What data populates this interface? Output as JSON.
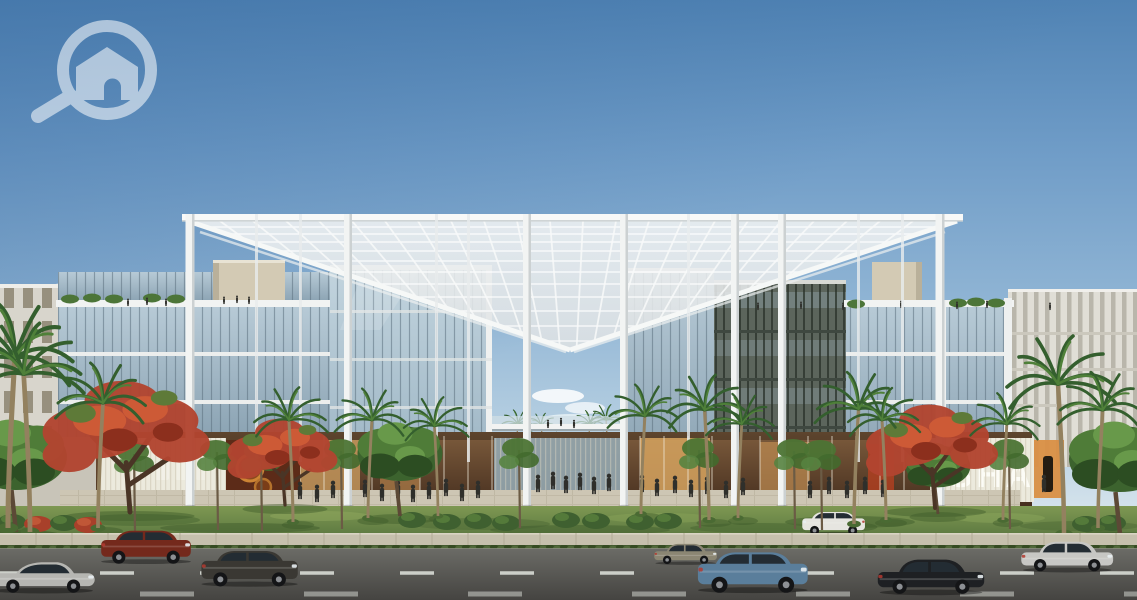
{
  "meta": {
    "type": "architectural-rendering",
    "subject": "Modern mixed-use office complex with large white pergola canopy, glass facades, palm and flame trees, plaza with pedestrians, and a street with cars",
    "canvas": {
      "w": 1137,
      "h": 600
    }
  },
  "watermark": {
    "icon": "magnifier-home-logo",
    "color": "#ffffff",
    "opacity": 0.55
  },
  "signage": {
    "storefront_sign": "SHA"
  },
  "palette": {
    "sky_top": "#5083b4",
    "sky_horizon": "#e8f0f3",
    "canopy": "#eef1f1",
    "glass": "#9fb6c5",
    "glass_dark": "#5c655c",
    "stone": "#d3cab4",
    "lawn": "#6d8a47",
    "road": "#55544f",
    "storefront_glow": "#c89a5e",
    "flame_tree": "#b24530",
    "palm_green": "#345f2e",
    "car_colors": [
      "#b6b6b2",
      "#74291c",
      "#3a3833",
      "#8b8673",
      "#5a7e9b",
      "#e6e5e0",
      "#1e2023",
      "#c7c7c4"
    ]
  },
  "scene": {
    "cars": [
      {
        "name": "car-silver-coupe",
        "type": "coupe",
        "color": "#b6b6b2",
        "x": -12,
        "y": 553,
        "s": 0.92
      },
      {
        "name": "car-dark-red-suv",
        "type": "suv",
        "color": "#74291c",
        "x": 98,
        "y": 528,
        "s": 0.8
      },
      {
        "name": "car-charcoal-suv",
        "type": "suv",
        "color": "#3a3833",
        "x": 198,
        "y": 548,
        "s": 0.86
      },
      {
        "name": "car-olive-sedan",
        "type": "sedan",
        "color": "#8b8673",
        "x": 652,
        "y": 540,
        "s": 0.56
      },
      {
        "name": "car-blue-suv",
        "type": "suv",
        "color": "#5a7e9b",
        "x": 694,
        "y": 549,
        "s": 0.98
      },
      {
        "name": "car-white-suv",
        "type": "suv",
        "color": "#e6e5e0",
        "x": 800,
        "y": 510,
        "s": 0.56,
        "flip": true,
        "behind": true
      },
      {
        "name": "car-black-sedan",
        "type": "sedan",
        "color": "#1e2023",
        "x": 874,
        "y": 553,
        "s": 0.95
      },
      {
        "name": "car-silver-sedan",
        "type": "sedan",
        "color": "#c7c7c4",
        "x": 1018,
        "y": 536,
        "s": 0.82
      }
    ],
    "palms": [
      {
        "x": 8,
        "y": 528,
        "h": 170
      },
      {
        "x": 30,
        "y": 532,
        "h": 158,
        "flip": 1
      },
      {
        "x": 98,
        "y": 528,
        "h": 125
      },
      {
        "x": 293,
        "y": 522,
        "h": 102,
        "flip": 1
      },
      {
        "x": 368,
        "y": 518,
        "h": 98
      },
      {
        "x": 438,
        "y": 516,
        "h": 90,
        "flip": 1
      },
      {
        "x": 641,
        "y": 514,
        "h": 98
      },
      {
        "x": 709,
        "y": 520,
        "h": 110,
        "flip": 1
      },
      {
        "x": 738,
        "y": 518,
        "h": 94
      },
      {
        "x": 854,
        "y": 524,
        "h": 115
      },
      {
        "x": 886,
        "y": 520,
        "h": 100,
        "flip": 1
      },
      {
        "x": 1003,
        "y": 520,
        "h": 96
      },
      {
        "x": 1064,
        "y": 534,
        "h": 150,
        "flip": 1
      },
      {
        "x": 1098,
        "y": 528,
        "h": 118
      }
    ],
    "gap_palms": [
      {
        "x": 516,
        "y": 468,
        "h": 44
      },
      {
        "x": 543,
        "y": 466,
        "h": 40,
        "flip": 1
      },
      {
        "x": 588,
        "y": 466,
        "h": 42
      },
      {
        "x": 608,
        "y": 468,
        "h": 48,
        "flip": 1
      }
    ],
    "flame_trees": [
      {
        "x": 130,
        "y": 512,
        "s": 1.9
      },
      {
        "x": 285,
        "y": 505,
        "s": 1.25
      },
      {
        "x": 935,
        "y": 508,
        "s": 1.5
      }
    ],
    "green_trees": [
      {
        "x": 400,
        "y": 516,
        "s": 1.25
      },
      {
        "x": 938,
        "y": 514,
        "s": 0.95
      },
      {
        "x": 16,
        "y": 532,
        "s": 1.5
      },
      {
        "x": 1120,
        "y": 534,
        "s": 1.5
      }
    ],
    "street_trees": [
      {
        "x": 135,
        "y": 532
      },
      {
        "x": 218,
        "y": 530
      },
      {
        "x": 262,
        "y": 531
      },
      {
        "x": 342,
        "y": 529
      },
      {
        "x": 520,
        "y": 528
      },
      {
        "x": 700,
        "y": 528
      },
      {
        "x": 795,
        "y": 529
      },
      {
        "x": 822,
        "y": 530
      },
      {
        "x": 1010,
        "y": 529
      }
    ],
    "bushes": [
      {
        "x": 12,
        "y": 522
      },
      {
        "x": 38,
        "y": 524,
        "red": true
      },
      {
        "x": 64,
        "y": 523
      },
      {
        "x": 88,
        "y": 525,
        "red": true
      },
      {
        "x": 412,
        "y": 520
      },
      {
        "x": 447,
        "y": 522
      },
      {
        "x": 478,
        "y": 521
      },
      {
        "x": 506,
        "y": 523
      },
      {
        "x": 566,
        "y": 520
      },
      {
        "x": 596,
        "y": 521
      },
      {
        "x": 640,
        "y": 522
      },
      {
        "x": 668,
        "y": 521
      },
      {
        "x": 1086,
        "y": 524
      },
      {
        "x": 1112,
        "y": 523
      }
    ],
    "roof_plants": [
      {
        "x": 70,
        "y": 299
      },
      {
        "x": 92,
        "y": 298
      },
      {
        "x": 114,
        "y": 299
      },
      {
        "x": 152,
        "y": 298
      },
      {
        "x": 176,
        "y": 299
      },
      {
        "x": 856,
        "y": 304
      },
      {
        "x": 958,
        "y": 303
      },
      {
        "x": 976,
        "y": 302
      },
      {
        "x": 996,
        "y": 303
      }
    ],
    "people_plaza": [
      [
        300,
        499
      ],
      [
        317,
        502
      ],
      [
        333,
        498
      ],
      [
        349,
        503
      ],
      [
        365,
        497
      ],
      [
        382,
        501
      ],
      [
        398,
        498
      ],
      [
        413,
        502
      ],
      [
        429,
        499
      ],
      [
        446,
        496
      ],
      [
        462,
        501
      ],
      [
        478,
        498
      ],
      [
        538,
        492
      ],
      [
        553,
        489
      ],
      [
        566,
        493
      ],
      [
        580,
        490
      ],
      [
        594,
        494
      ],
      [
        609,
        491
      ],
      [
        625,
        495
      ],
      [
        642,
        492
      ],
      [
        657,
        496
      ],
      [
        675,
        493
      ],
      [
        691,
        497
      ],
      [
        707,
        494
      ],
      [
        726,
        498
      ],
      [
        743,
        495
      ],
      [
        810,
        498
      ],
      [
        829,
        494
      ],
      [
        847,
        498
      ],
      [
        865,
        494
      ],
      [
        883,
        497
      ],
      [
        1044,
        492
      ]
    ],
    "people_roof": [
      [
        128,
        306
      ],
      [
        147,
        305
      ],
      [
        166,
        306
      ],
      [
        224,
        304
      ],
      [
        237,
        303
      ],
      [
        249,
        304
      ],
      [
        758,
        310
      ],
      [
        801,
        309
      ],
      [
        843,
        310
      ],
      [
        901,
        308
      ],
      [
        957,
        309
      ],
      [
        987,
        308
      ],
      [
        1050,
        310
      ]
    ],
    "people_bridge": [
      [
        548,
        428
      ],
      [
        561,
        426
      ],
      [
        574,
        428
      ]
    ]
  }
}
